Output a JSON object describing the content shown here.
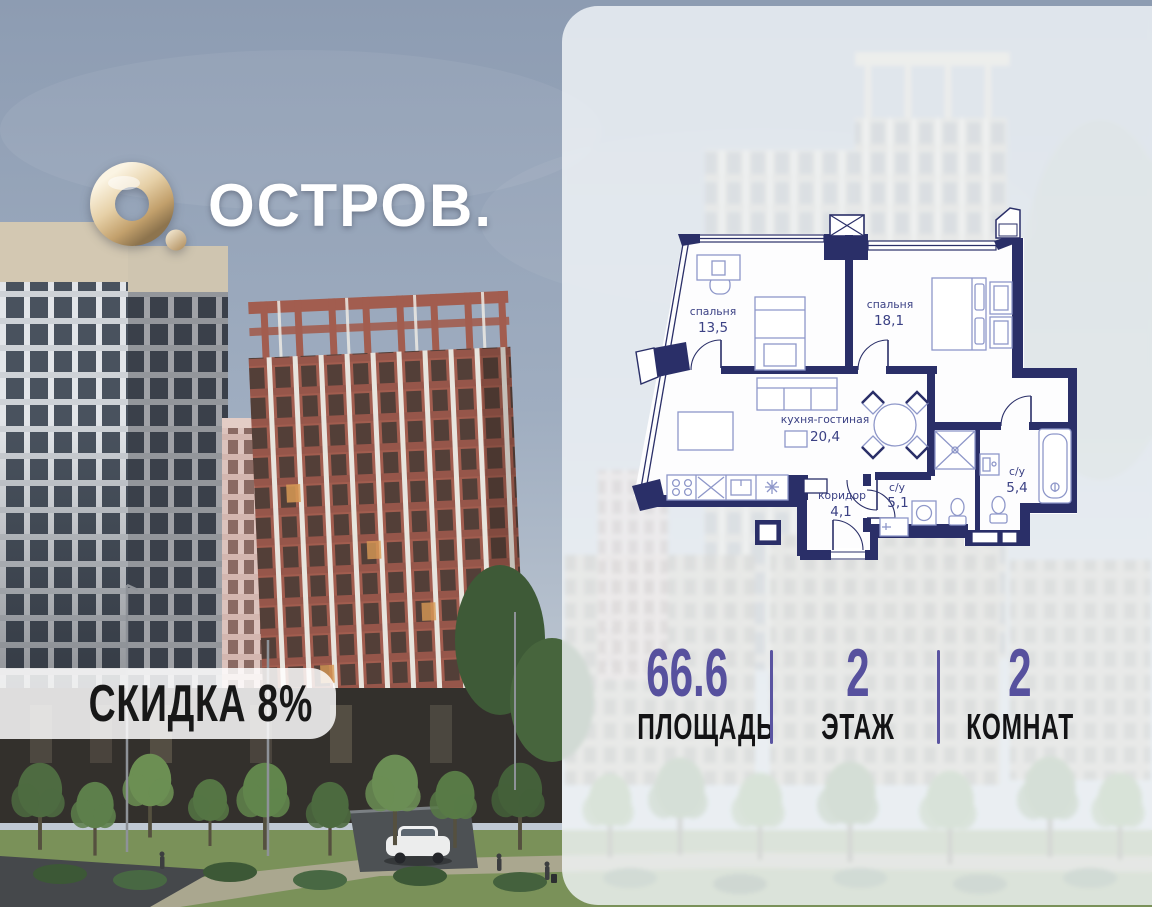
{
  "brand": {
    "name": "ОСТРОВ.",
    "logo_mark": "gold-ring-o-with-dot"
  },
  "badge": {
    "label": "СКИДКА 8%"
  },
  "floor_plan": {
    "rooms": [
      {
        "name": "спальня",
        "area": "13,5"
      },
      {
        "name": "спальня",
        "area": "18,1"
      },
      {
        "name": "кухня-гостиная",
        "area": "20,4"
      },
      {
        "name": "коридор",
        "area": "4,1"
      },
      {
        "name": "с/у",
        "area": "5,1"
      },
      {
        "name": "с/у",
        "area": "5,4"
      }
    ]
  },
  "stats": {
    "items": [
      {
        "value": "66.6",
        "label": "ПЛОЩАДЬ"
      },
      {
        "value": "2",
        "label": "ЭТАЖ"
      },
      {
        "value": "2",
        "label": "КОМНАТ"
      }
    ]
  },
  "colors": {
    "wall_navy": "#2a2f68",
    "accent_purple": "#57519e",
    "gold": "#c9ab7c",
    "panel": "rgba(244,247,250,0.80)"
  }
}
